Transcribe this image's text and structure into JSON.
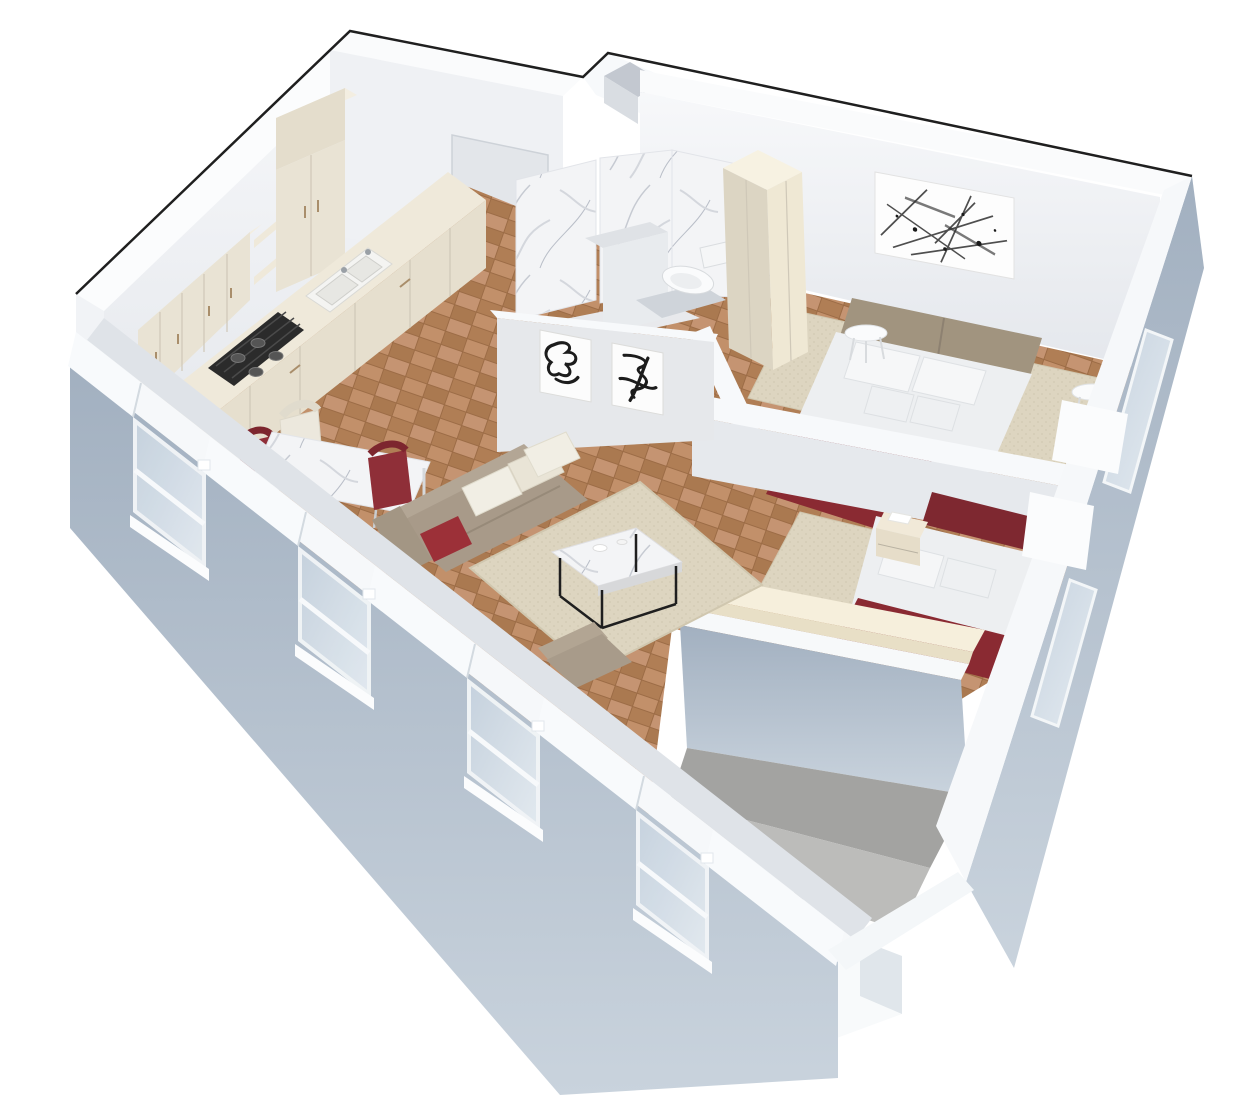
{
  "scene": {
    "type": "3d-isometric-apartment-floorplan-render",
    "background": "#ffffff",
    "outline_color": "#1f1f1f"
  },
  "palette": {
    "wall_top_white": "#f8fafb",
    "wall_inner": "#eef0f3",
    "wall_gray": "#e3e6ea",
    "wall_gray_dark": "#d9dde2",
    "exterior_blue": "#aebbc9",
    "rug_beige": "#ddd5c0",
    "rug_border": "#d0c7af",
    "marble_white": "#f3f4f6",
    "cabinet_cream": "#e9e3d4",
    "cabinet_cream_top": "#f3eee1",
    "cabinet_cream_side": "#dcd5c3",
    "counter_cream": "#efe9da",
    "slab_cream": "#f6efdc",
    "sofa_taupe": "#a89a89",
    "sofa_back_taupe": "#b3a695",
    "pillow_white": "#f1eee4",
    "accent_red": "#8a2a32",
    "chair_red": "#8f2f38",
    "headboard_red": "#7e2830",
    "bed_white": "#edeff1",
    "headboard_taupe": "#a1947f",
    "terrace_concrete": "#a3a3a1",
    "terrace_step": "#bcbcba",
    "glass_blue": "#c7d3df",
    "cooktop_black": "#2b2b2b",
    "art_ink": "#1c1c1c",
    "shower_gray": "#cfd4da"
  },
  "rooms": [
    {
      "name": "kitchen",
      "furniture": [
        "upper-cabinets",
        "open-shelves",
        "tall-cabinet",
        "counter-with-double-sink",
        "gas-cooktop",
        "base-cabinets"
      ]
    },
    {
      "name": "dining-area",
      "furniture": [
        "marble-dining-table",
        "red-chair",
        "red-chair",
        "white-chair"
      ]
    },
    {
      "name": "living-room",
      "furniture": [
        "beige-rug",
        "taupe-sofa",
        "white-pillows",
        "red-pillow",
        "marble-coffee-table",
        "taupe-armchair"
      ]
    },
    {
      "name": "bathroom",
      "furniture": [
        "marble-walls",
        "vanity-block",
        "toilet",
        "shower-floor"
      ]
    },
    {
      "name": "hallway",
      "furniture": [
        "entry-door",
        "framed-calligraphy-art-1",
        "framed-calligraphy-art-2"
      ]
    },
    {
      "name": "bedroom-1",
      "furniture": [
        "double-bed",
        "taupe-headboard-cushions",
        "white-pillows",
        "red-throw-blanket",
        "splatter-artwork",
        "cream-wardrobe",
        "round-side-table-left",
        "round-side-table-right",
        "beige-rug"
      ]
    },
    {
      "name": "bedroom-2",
      "furniture": [
        "bed-red-headboard",
        "white-pillows",
        "red-blanket",
        "cream-nightstand",
        "long-cream-cabinet",
        "beige-rug"
      ]
    },
    {
      "name": "terrace",
      "furniture": [
        "concrete-floor",
        "step",
        "parapet-walls"
      ]
    }
  ],
  "windows": {
    "southwest_wall_count": 4,
    "east_wall_count": 2
  },
  "counts": {
    "framed_artworks": 3,
    "beds": 2,
    "side_tables": 2
  }
}
